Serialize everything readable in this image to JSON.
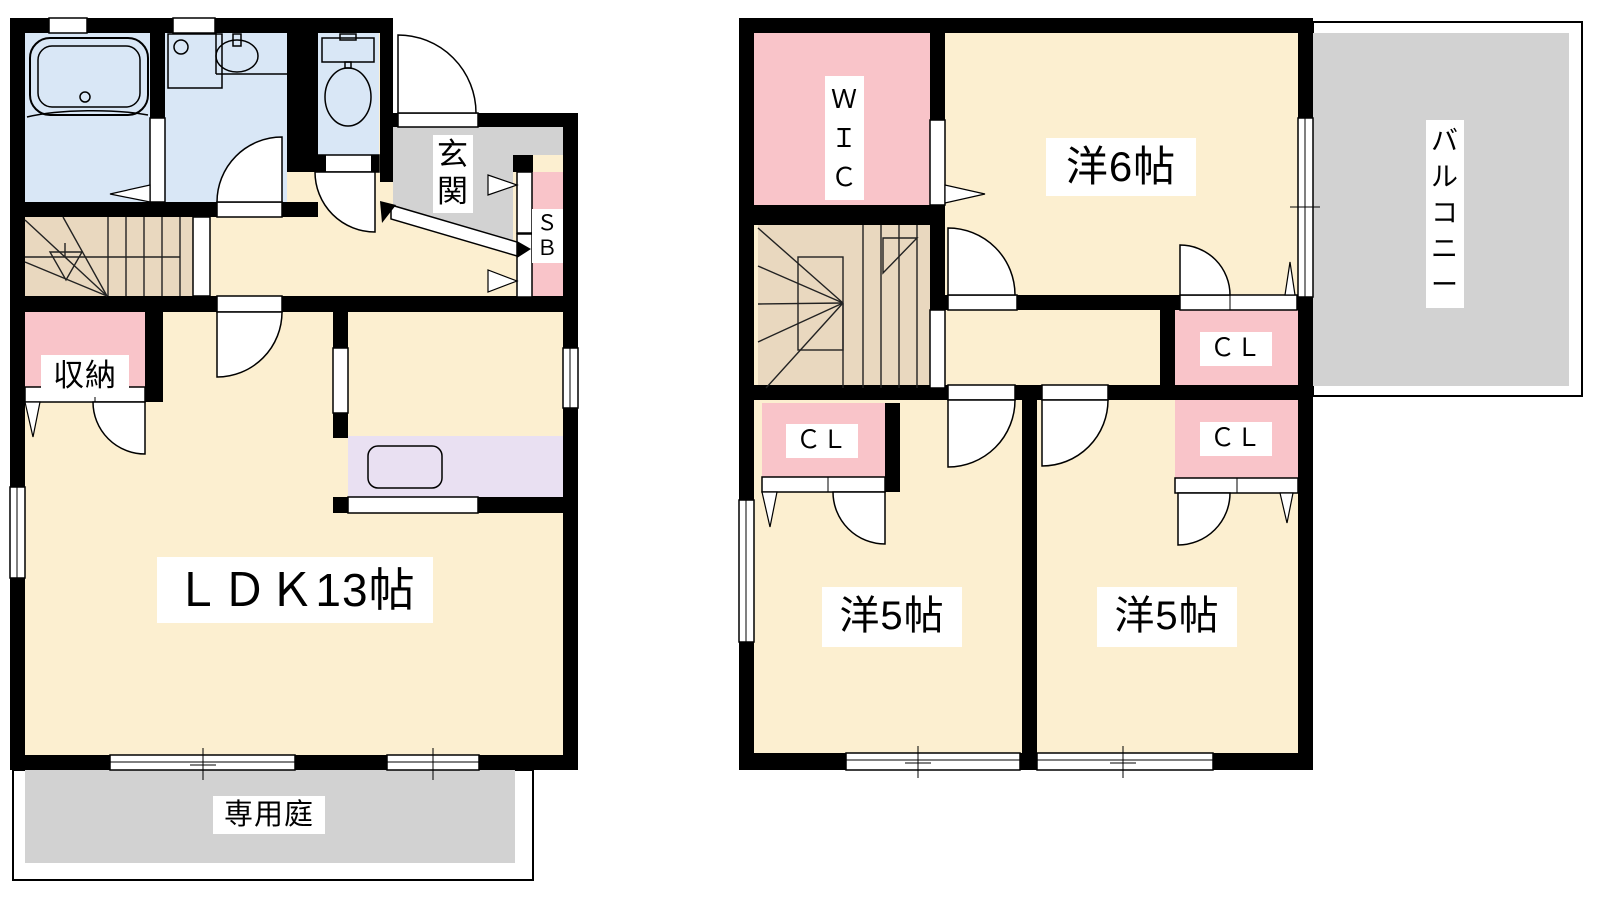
{
  "plan_title": "2-story residence floor plan",
  "colors": {
    "wall": "#000000",
    "room_cream": "#fcefd0",
    "water_blue": "#d9e7f6",
    "closet_pink": "#f9c4c9",
    "stairs_tan": "#e9d8bf",
    "kitchen_purple": "#e9e0f2",
    "outdoor_gray": "#d2d2d2",
    "line": "#000000"
  },
  "floor1": {
    "ldk_label": "ＬＤＫ13帖",
    "entrance_label": "玄\n関",
    "storage_label": "収納",
    "shoebox_label": "Ｓ\nＢ",
    "garden_label": "専用庭"
  },
  "floor2": {
    "wic_label": "Ｗ\nＩ\nＣ",
    "bedroom6_label": "洋6帖",
    "bedroom5_left_label": "洋5帖",
    "bedroom5_right_label": "洋5帖",
    "closet_left_label": "ＣＬ",
    "closet_top_label": "ＣＬ",
    "closet_bottom_label": "ＣＬ",
    "balcony_label": "バ\nル\nコ\nニ\nー"
  }
}
